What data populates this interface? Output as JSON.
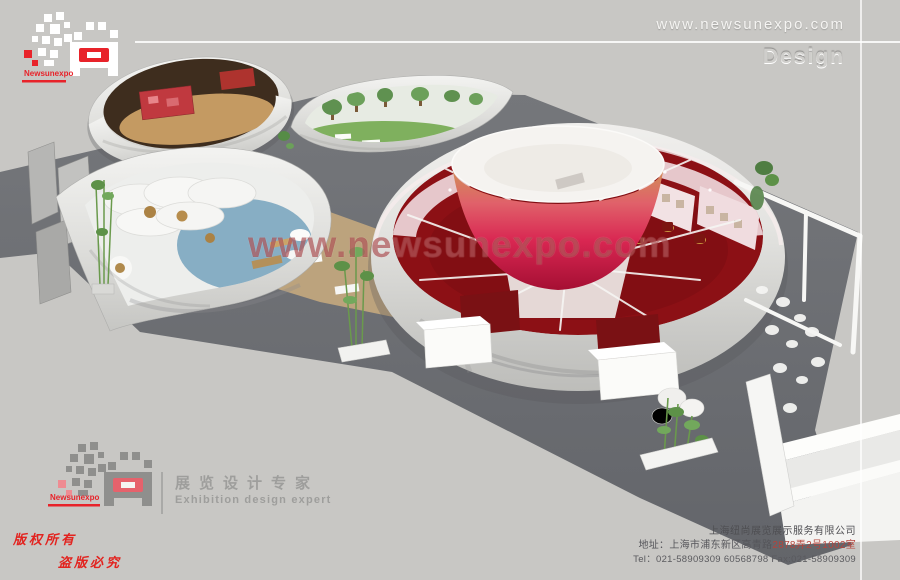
{
  "header": {
    "website": "www.newsunexpo.com",
    "design_label": "Design"
  },
  "watermark": {
    "text": "www.newsunexpo.com"
  },
  "brand": {
    "name": "Newsunexpo",
    "tagline_cn": "展览设计专家",
    "tagline_en": "Exhibition design expert"
  },
  "copyright": {
    "line1": "版权所有",
    "line2": "盗版必究"
  },
  "company": {
    "name": "上海纽尚展览展示服务有限公司",
    "address_prefix": "地址：上海市浦东新区高青路",
    "address_number": "2878弄2号1002室",
    "phone": "Tel：021-58909309 60568798  Fax:021-58909309"
  },
  "scene": {
    "palette": {
      "background": "#c8c7c4",
      "exhibit_floor": "#6f7174",
      "marble_wall": "#ececea",
      "carpet_red": "#8c1015",
      "bowl_red": "#d92752",
      "interior_pink": "#ebd2d5",
      "pool_blue": "#7ba6c0",
      "grass_green": "#7fb05e",
      "wood_brown": "#3e2d1e",
      "deck_tan": "#c4a87e",
      "logo_red": "#e8232a",
      "watermark_red": "#921a1c"
    }
  }
}
